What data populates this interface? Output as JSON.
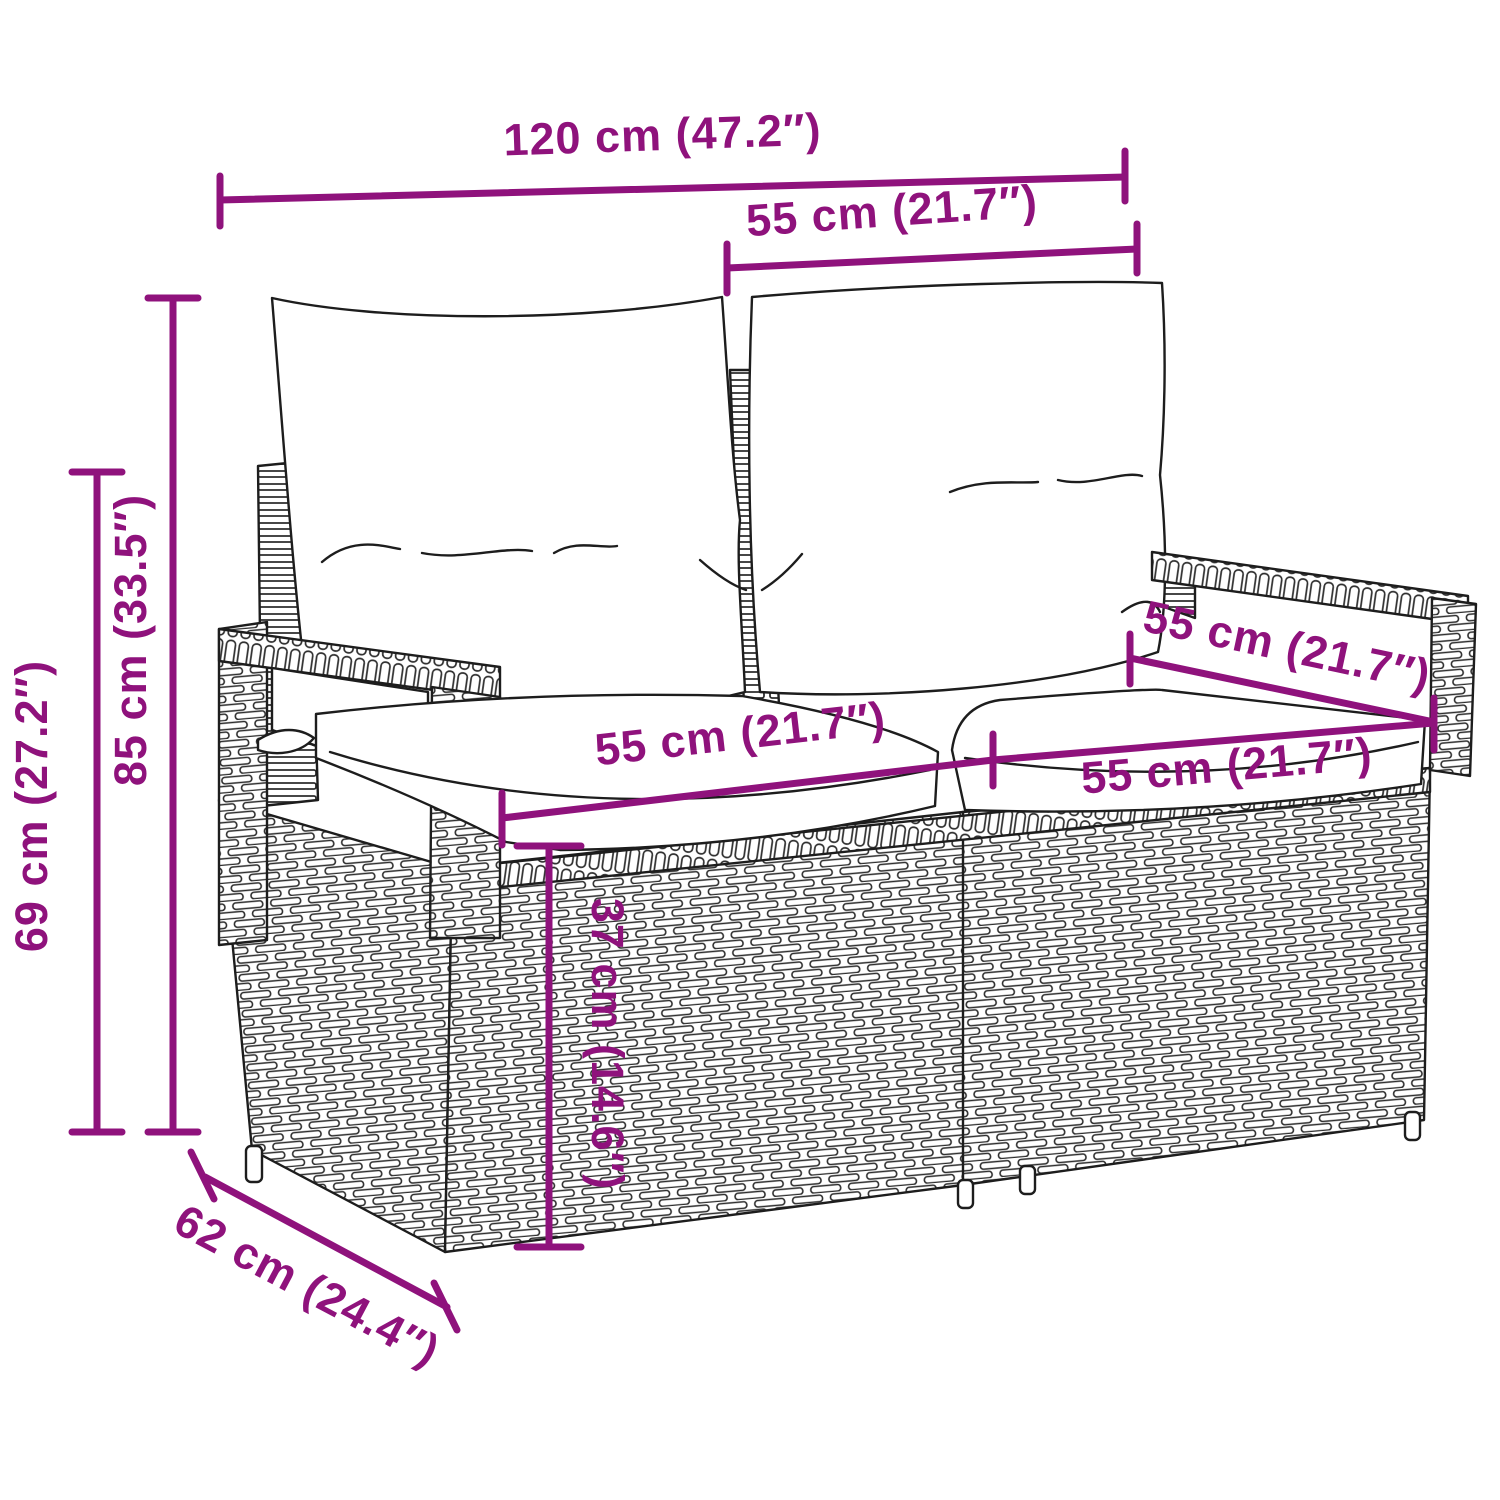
{
  "title": "Rattan garden bench dimension diagram",
  "colors": {
    "dimension_color": "#8F127C",
    "line_color": "#1d1d1d",
    "background": "#ffffff"
  },
  "dimensions": {
    "overall_width": "120 cm (47.2″)",
    "back_cushion_width": "55 cm (21.7″)",
    "overall_height": "85 cm (33.5″)",
    "armrest_height": "69 cm (27.2″)",
    "seat_width_left": "55 cm (21.7″)",
    "seat_width_right": "55 cm (21.7″)",
    "seat_depth_diagonal": "55 cm (21.7″)",
    "seat_height": "37 cm (14.6″)",
    "overall_depth": "62 cm (24.4″)"
  }
}
